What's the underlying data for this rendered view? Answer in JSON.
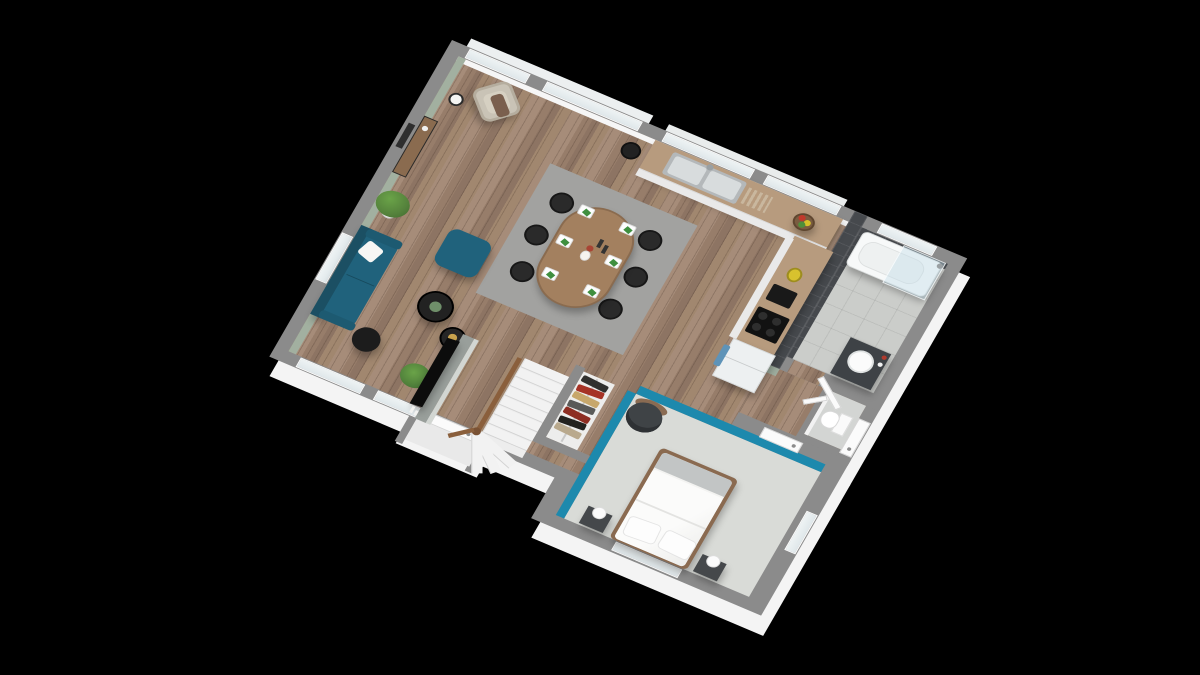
{
  "scene": {
    "kind": "isometric-3d-floor-plan-render",
    "background": "#000000",
    "storey": "single-level-apartment",
    "view": "elevated-south-east-axonometric"
  },
  "palette": {
    "wallTop": "#8b8b8b",
    "exteriorWhite": "#f4f4f4",
    "interiorWhite": "#f6f6f6",
    "sageWall": "#a2b0a0",
    "tealWall": "#1d89ad",
    "tealFurniture": "#20627c",
    "woodFloor": "#9d8471",
    "counterWood": "#b79b7e",
    "darkTile": "#46494d",
    "bathFloor": "#cbcdca",
    "carpet": "#d9dbd7",
    "rug": "#a2a2a0",
    "blackFurniture": "#2a2a2a",
    "bedFrameWood": "#8a6a50",
    "plantGreen": "#55823c",
    "accentYellow": "#d8c22e",
    "towelBlue": "#5e93b8"
  },
  "rooms": [
    {
      "name": "living-room",
      "floor": "wood",
      "wall_accent": "sage-green"
    },
    {
      "name": "dining-area",
      "floor": "wood",
      "rug": "grey"
    },
    {
      "name": "kitchen",
      "floor": "wood",
      "cabinets": "white",
      "worktop": "wood"
    },
    {
      "name": "bathroom",
      "floor": "grey-tile",
      "walls": "dark-grey-tile"
    },
    {
      "name": "wc",
      "floor": "grey",
      "walls": "white"
    },
    {
      "name": "bedroom",
      "floor": "light-grey-carpet",
      "wall_accent": "teal"
    },
    {
      "name": "entry-hall",
      "floor": "wood"
    },
    {
      "name": "closet-nook",
      "contents": "hanging-clothes"
    }
  ],
  "furniture": {
    "living": [
      "beige-armchair-with-throw",
      "white-shade-floor-lamp",
      "console-table",
      "wall-art",
      "large-plant",
      "teal-sofa-with-white-pillow",
      "black-dome-floor-lamp",
      "teal-pouf",
      "two-black-round-coffee-tables",
      "floor-plant",
      "tv-partition-wall",
      "flat-screen-tv",
      "floor-candles"
    ],
    "dining": [
      "oval-wood-table",
      "six-black-chairs",
      "six-place-settings",
      "flower-vase",
      "candlesticks",
      "grey-rug",
      "black-side-stool"
    ],
    "kitchen": [
      "l-shaped-counter",
      "double-stainless-sink",
      "fruit-bowl",
      "yellow-blender",
      "black-countertop-appliance",
      "black-cooktop",
      "fridge-with-blue-towel"
    ],
    "bathroom": [
      "bathtub-with-glass-screen",
      "dark-vanity-round-basin",
      "toiletry-bottles",
      "window-above-tub"
    ],
    "wc": [
      "wall-hung-toilet"
    ],
    "bedroom": [
      "double-bed-white-duvet",
      "two-pillows",
      "grey-throw",
      "two-dark-nightstands",
      "two-white-ball-lamps",
      "dark-round-armchair",
      "open-closet-with-clothes"
    ],
    "circulation": [
      "winder-staircase-wood-rail",
      "front-door",
      "bathroom-door",
      "wc-door",
      "bedroom-door",
      "side-exit-door"
    ]
  },
  "openings": {
    "north_glazing_sections": 5,
    "south_windows": 2,
    "west_window": 1,
    "bedroom_windows": 2,
    "doors": 6
  }
}
